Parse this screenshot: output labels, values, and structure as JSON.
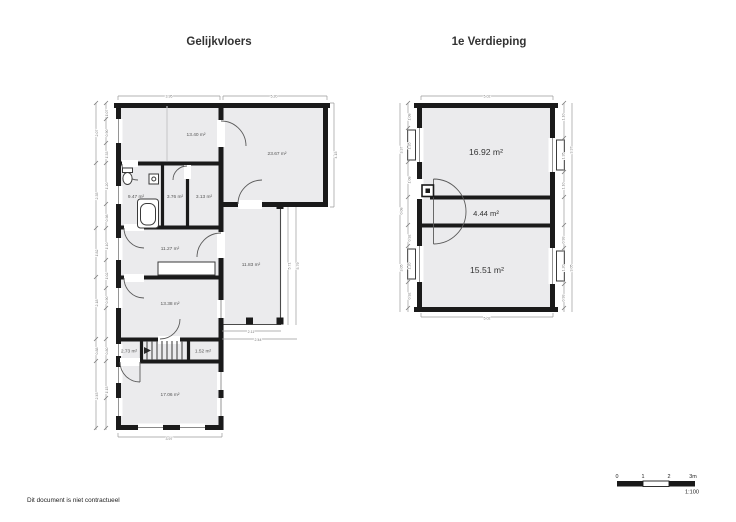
{
  "titles": {
    "ground": "Gelijkvloers",
    "first": "1e Verdieping"
  },
  "ground": {
    "rooms": {
      "r1340": "13.40 m²",
      "r2367": "23.67 m²",
      "r947": "9.47 m²",
      "r376": "3.76 m²",
      "r313": "3.13 m²",
      "r1127": "11.27 m²",
      "r1183": "11.83 m²",
      "r1338": "13.38 m²",
      "r273": "2.73 m²",
      "r152": "1.52 m²",
      "r1706": "17.06 m²"
    },
    "dims": {
      "top_left": "3.95",
      "top_right": "5.20",
      "bottom": "3.97",
      "right": "4.15",
      "terrace_right_inner": "5.71",
      "terrace_right_outer": "5.79",
      "terrace_bottom_1": "2.11",
      "terrace_bottom_2": "2.44",
      "left_outer": [
        "2.07",
        "2.35",
        "1.82",
        "2.18",
        "0.88",
        "2.45"
      ],
      "left_inner": [
        "1.07",
        "0.90",
        "1.33",
        "1.20",
        "0.98",
        "1.10",
        "1.02",
        "0.90",
        "0.80",
        "1.15"
      ]
    }
  },
  "first": {
    "rooms": {
      "r1692": "16.92 m²",
      "r444": "4.44 m²",
      "r1551": "15.51 m²"
    },
    "dims": {
      "top": "5.02",
      "bottom": "5.02",
      "left_outer": [
        "3.37",
        "0.08",
        "3.05"
      ],
      "left_inner": [
        "1.08",
        "1.35",
        "1.08",
        "0.92",
        "1.20",
        "0.92"
      ],
      "right_inner": [
        "1.10",
        "1.35",
        "1.10",
        "0.93",
        "1.20",
        "0.93"
      ],
      "right_outer": [
        "3.37",
        "3.05"
      ]
    }
  },
  "footer": {
    "disclaimer": "Dit document is niet contractueel"
  },
  "scalebar": {
    "ticks": [
      "0",
      "1",
      "2",
      "3m"
    ],
    "ratio": "1:100"
  }
}
